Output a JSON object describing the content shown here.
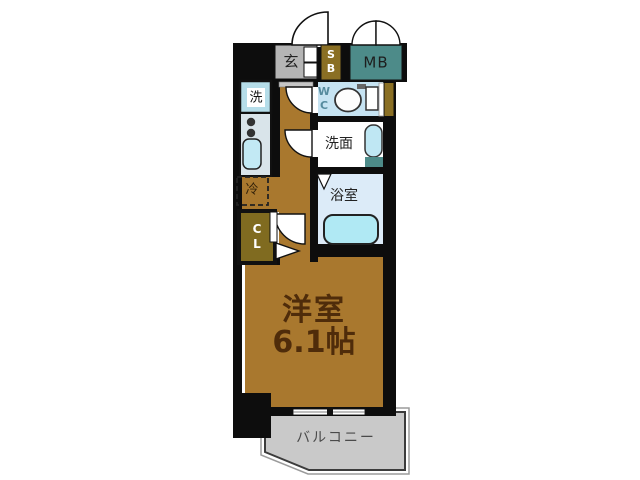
{
  "floorplan": {
    "labels": {
      "genkan": "玄",
      "shoe_box": "SB",
      "meter_box": "MB",
      "washer": "洗",
      "wc": "WC",
      "washroom": "洗面",
      "bathroom": "浴室",
      "refrigerator": "冷",
      "closet": "CL",
      "main_room_name": "洋室",
      "main_room_size": "6.1帖",
      "balcony": "バルコニー"
    },
    "colors": {
      "wall": "#0d0d0d",
      "wood_floor": "#a9782e",
      "meter_box": "#4d8b89",
      "shoe_box": "#8a6f24",
      "closet": "#806b20",
      "wc_floor": "#c6e3f2",
      "bathroom_floor": "#dcebf8",
      "bathtub": "#b0e9f4",
      "genkan_floor": "#b5b5b5",
      "balcony_floor": "#c9c9c9",
      "kitchen_counter": "#d9e4ea",
      "sink": "#c2e9f4",
      "room_text": "#4f2c0a"
    }
  }
}
